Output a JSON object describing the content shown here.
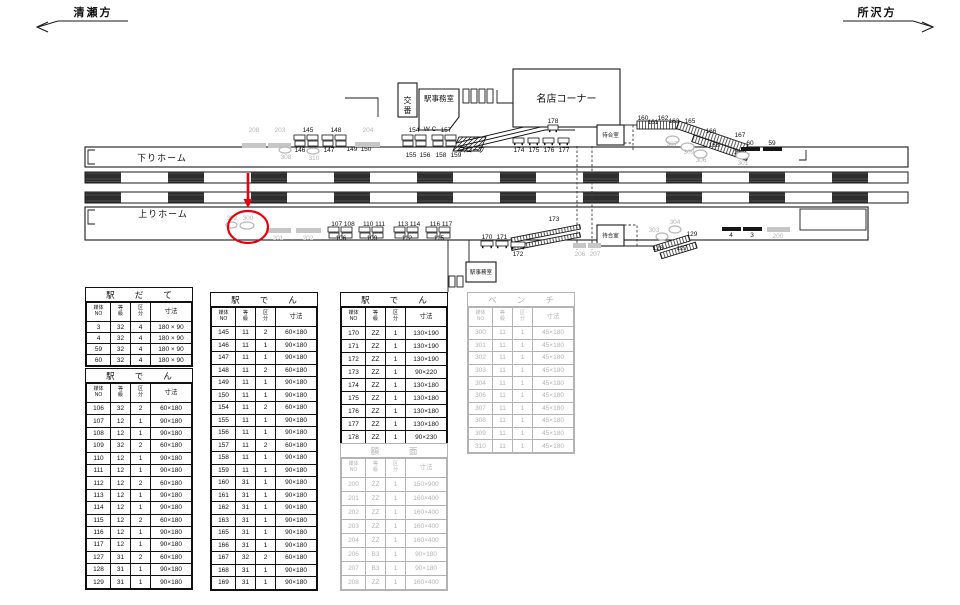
{
  "directions": {
    "left": "清瀬方",
    "right": "所沢方"
  },
  "diagram": {
    "down_platform": "下りホーム",
    "up_platform": "上りホーム",
    "buildings": [
      {
        "name": "koban",
        "label": "交番",
        "x": 398,
        "y": 83,
        "w": 19,
        "h": 34,
        "vertical": true,
        "fs": 8
      },
      {
        "name": "station-office-down",
        "label": "駅事務室",
        "x": 419,
        "y": 89,
        "w": 40,
        "h": 41,
        "fs": 7.5,
        "ty": 101,
        "pent": true
      },
      {
        "name": "meiten-corner",
        "label": "名店コーナー",
        "x": 513,
        "y": 69,
        "w": 107,
        "h": 58,
        "fs": 10
      },
      {
        "name": "waiting-room-down",
        "label": "待合室",
        "x": 597,
        "y": 125,
        "w": 27,
        "h": 20,
        "fs": 5.5
      },
      {
        "name": "waiting-room-up",
        "label": "待合室",
        "x": 597,
        "y": 225,
        "w": 27,
        "h": 21,
        "fs": 5.5
      },
      {
        "name": "station-office-up",
        "label": "駅事務室",
        "x": 466,
        "y": 262,
        "w": 30,
        "h": 20,
        "fs": 5.5
      }
    ],
    "markers": [
      {
        "t": "graybar",
        "x": 242,
        "y": 143,
        "w": 24,
        "label": "208",
        "lx": 254,
        "ly": 132,
        "gray": true
      },
      {
        "t": "graybar",
        "x": 268,
        "y": 143,
        "w": 23,
        "label": "203",
        "lx": 280,
        "ly": 132,
        "gray": true
      },
      {
        "t": "cluster",
        "x": 294,
        "y": 135,
        "label": "145",
        "lx": 308,
        "ly": 132
      },
      {
        "t": "oval",
        "x": 279,
        "y": 147,
        "w": 12,
        "h": 6,
        "label": "308",
        "lx": 286,
        "ly": 159,
        "gray": true
      },
      {
        "t": "label",
        "label": "146",
        "lx": 300,
        "ly": 152
      },
      {
        "t": "oval",
        "x": 307,
        "y": 148,
        "w": 12,
        "h": 6,
        "label": "310",
        "lx": 314,
        "ly": 160,
        "gray": true
      },
      {
        "t": "label",
        "label": "147",
        "lx": 329,
        "ly": 152
      },
      {
        "t": "cluster",
        "x": 322,
        "y": 135,
        "label": "148",
        "lx": 336,
        "ly": 132
      },
      {
        "t": "label",
        "label": "149",
        "lx": 352,
        "ly": 151
      },
      {
        "t": "label",
        "label": "150",
        "lx": 366,
        "ly": 151
      },
      {
        "t": "graybar",
        "x": 355,
        "y": 142,
        "w": 25,
        "label": "204",
        "lx": 368,
        "ly": 132,
        "gray": true
      },
      {
        "t": "cluster",
        "x": 402,
        "y": 135,
        "label": "154",
        "lx": 414,
        "ly": 132
      },
      {
        "t": "label",
        "label": "W C",
        "lx": 430,
        "ly": 131
      },
      {
        "t": "cluster",
        "x": 432,
        "y": 135,
        "label": "157",
        "lx": 446,
        "ly": 132
      },
      {
        "t": "label",
        "label": "155",
        "lx": 411,
        "ly": 157
      },
      {
        "t": "label",
        "label": "156",
        "lx": 425,
        "ly": 157
      },
      {
        "t": "label",
        "label": "158",
        "lx": 441,
        "ly": 157
      },
      {
        "t": "label",
        "label": "159",
        "lx": 456,
        "ly": 157
      },
      {
        "t": "label",
        "label": "スロープ",
        "lx": 472,
        "ly": 152,
        "fs": 5.5
      },
      {
        "t": "board",
        "x": 513,
        "y": 138,
        "w": 11,
        "label": "174",
        "lx": 519,
        "ly": 152
      },
      {
        "t": "board",
        "x": 528,
        "y": 138,
        "w": 11,
        "label": "175",
        "lx": 534,
        "ly": 152
      },
      {
        "t": "board",
        "x": 543,
        "y": 138,
        "w": 11,
        "label": "176",
        "lx": 549,
        "ly": 152
      },
      {
        "t": "board",
        "x": 558,
        "y": 138,
        "w": 11,
        "label": "177",
        "lx": 564,
        "ly": 152
      },
      {
        "t": "board",
        "x": 548,
        "y": 125,
        "w": 10,
        "label": "178",
        "lx": 553,
        "ly": 123
      },
      {
        "t": "label",
        "label": "160",
        "lx": 643,
        "ly": 120
      },
      {
        "t": "label",
        "label": "161",
        "lx": 653,
        "ly": 124
      },
      {
        "t": "label",
        "label": "162",
        "lx": 663,
        "ly": 120
      },
      {
        "t": "label",
        "label": "163",
        "lx": 674,
        "ly": 123
      },
      {
        "t": "label",
        "label": "165",
        "lx": 690,
        "ly": 123
      },
      {
        "t": "label",
        "label": "166",
        "lx": 711,
        "ly": 133
      },
      {
        "t": "label",
        "label": "167",
        "lx": 740,
        "ly": 137
      },
      {
        "t": "label",
        "label": "168",
        "lx": 714,
        "ly": 147
      },
      {
        "t": "label",
        "label": "169",
        "lx": 739,
        "ly": 154
      },
      {
        "t": "oval",
        "x": 666,
        "y": 136,
        "w": 13,
        "h": 8,
        "label": "307",
        "lx": 672,
        "ly": 146,
        "gray": true
      },
      {
        "t": "oval",
        "x": 681,
        "y": 143,
        "w": 13,
        "h": 8,
        "label": "309",
        "lx": 689,
        "ly": 154,
        "gray": true
      },
      {
        "t": "oval",
        "x": 694,
        "y": 150,
        "w": 13,
        "h": 8,
        "label": "306",
        "lx": 701,
        "ly": 162,
        "gray": true
      },
      {
        "t": "blackbar",
        "x": 741,
        "y": 147,
        "w": 19,
        "label": "60",
        "lx": 750,
        "ly": 145
      },
      {
        "t": "blackbar",
        "x": 763,
        "y": 147,
        "w": 19,
        "label": "59",
        "lx": 772,
        "ly": 145
      },
      {
        "t": "oval",
        "x": 736,
        "y": 152,
        "w": 13,
        "h": 7,
        "label": "301",
        "lx": 743,
        "ly": 165,
        "gray": true
      },
      {
        "t": "oval",
        "x": 226,
        "y": 222,
        "w": 11,
        "h": 6,
        "label": "302",
        "lx": 232,
        "ly": 220,
        "gray": true
      },
      {
        "t": "oval",
        "x": 240,
        "y": 222,
        "w": 14,
        "h": 7,
        "label": "300",
        "lx": 248,
        "ly": 220,
        "gray": true
      },
      {
        "t": "graybar",
        "x": 266,
        "y": 228,
        "w": 25,
        "label": "201",
        "lx": 278,
        "ly": 240,
        "gray": true
      },
      {
        "t": "graybar",
        "x": 296,
        "y": 228,
        "w": 25,
        "label": "202",
        "lx": 308,
        "ly": 240,
        "gray": true
      },
      {
        "t": "cluster",
        "x": 328,
        "y": 227
      },
      {
        "t": "label",
        "label": "107 108",
        "lx": 343,
        "ly": 226
      },
      {
        "t": "label",
        "label": "106",
        "lx": 341,
        "ly": 240
      },
      {
        "t": "cluster",
        "x": 359,
        "y": 227
      },
      {
        "t": "label",
        "label": "110 111",
        "lx": 374,
        "ly": 226
      },
      {
        "t": "label",
        "label": "109",
        "lx": 372,
        "ly": 240
      },
      {
        "t": "cluster",
        "x": 394,
        "y": 227
      },
      {
        "t": "label",
        "label": "113 114",
        "lx": 409,
        "ly": 226
      },
      {
        "t": "label",
        "label": "112",
        "lx": 407,
        "ly": 240
      },
      {
        "t": "cluster",
        "x": 426,
        "y": 227
      },
      {
        "t": "label",
        "label": "116 117",
        "lx": 441,
        "ly": 226
      },
      {
        "t": "label",
        "label": "115",
        "lx": 439,
        "ly": 240
      },
      {
        "t": "board",
        "x": 481,
        "y": 241,
        "w": 12,
        "label": "170",
        "lx": 487,
        "ly": 239
      },
      {
        "t": "board",
        "x": 496,
        "y": 241,
        "w": 12,
        "label": "171",
        "lx": 502,
        "ly": 239
      },
      {
        "t": "board",
        "x": 511,
        "y": 242,
        "w": 14,
        "label": "172",
        "lx": 518,
        "ly": 256
      },
      {
        "t": "label",
        "label": "173",
        "lx": 554,
        "ly": 221
      },
      {
        "t": "graybar",
        "x": 573,
        "y": 243,
        "w": 13,
        "label": "206",
        "lx": 580,
        "ly": 256,
        "gray": true
      },
      {
        "t": "graybar",
        "x": 588,
        "y": 243,
        "w": 13,
        "label": "207",
        "lx": 595,
        "ly": 256,
        "gray": true
      },
      {
        "t": "oval",
        "x": 656,
        "y": 233,
        "w": 12,
        "h": 7,
        "label": "303",
        "lx": 654,
        "ly": 232,
        "gray": true,
        "anchor": "end"
      },
      {
        "t": "oval",
        "x": 669,
        "y": 226,
        "w": 12,
        "h": 7,
        "label": "304",
        "lx": 675,
        "ly": 224,
        "gray": true
      },
      {
        "t": "label",
        "label": "128",
        "lx": 658,
        "ly": 250
      },
      {
        "t": "label",
        "label": "127",
        "lx": 682,
        "ly": 250
      },
      {
        "t": "label",
        "label": "129",
        "lx": 692,
        "ly": 236
      },
      {
        "t": "blackbar",
        "x": 722,
        "y": 227,
        "w": 19,
        "label": "4",
        "lx": 731,
        "ly": 237
      },
      {
        "t": "blackbar",
        "x": 743,
        "y": 227,
        "w": 19,
        "label": "3",
        "lx": 752,
        "ly": 237
      },
      {
        "t": "graybar",
        "x": 767,
        "y": 227,
        "w": 23,
        "label": "200",
        "lx": 778,
        "ly": 238,
        "gray": true
      }
    ]
  },
  "annotation_color": "#e8000d",
  "table_header": [
    [
      "媒体",
      "NO"
    ],
    [
      "等",
      "級"
    ],
    [
      "区",
      "分"
    ],
    [
      "寸法"
    ]
  ],
  "tables": [
    {
      "name": "eki-date",
      "title": "駅だて",
      "gray": false,
      "x": 85,
      "y": 287,
      "w": 108,
      "rowH": 11,
      "rows": [
        [
          "3",
          "32",
          "4",
          "180 × 90"
        ],
        [
          "4",
          "32",
          "4",
          "180 × 90"
        ],
        [
          "59",
          "32",
          "4",
          "180 × 90"
        ],
        [
          "60",
          "32",
          "4",
          "180 × 90"
        ]
      ]
    },
    {
      "name": "eki-den-1",
      "title": "駅でん",
      "gray": false,
      "x": 85,
      "y": 368,
      "w": 108,
      "rowH": 12.4,
      "rows": [
        [
          "106",
          "32",
          "2",
          "60×180"
        ],
        [
          "107",
          "12",
          "1",
          "90×180"
        ],
        [
          "108",
          "12",
          "1",
          "90×180"
        ],
        [
          "109",
          "32",
          "2",
          "60×180"
        ],
        [
          "110",
          "12",
          "1",
          "90×180"
        ],
        [
          "111",
          "12",
          "1",
          "90×180"
        ],
        [
          "112",
          "12",
          "2",
          "60×180"
        ],
        [
          "113",
          "12",
          "1",
          "90×180"
        ],
        [
          "114",
          "12",
          "1",
          "90×180"
        ],
        [
          "115",
          "12",
          "2",
          "60×180"
        ],
        [
          "116",
          "12",
          "1",
          "90×180"
        ],
        [
          "117",
          "12",
          "1",
          "90×180"
        ],
        [
          "127",
          "31",
          "2",
          "60×180"
        ],
        [
          "128",
          "31",
          "1",
          "90×180"
        ],
        [
          "129",
          "31",
          "1",
          "90×180"
        ]
      ]
    },
    {
      "name": "eki-den-2",
      "title": "駅でん",
      "gray": false,
      "x": 210,
      "y": 292,
      "w": 108,
      "rowH": 12.5,
      "rows": [
        [
          "145",
          "11",
          "2",
          "60×180"
        ],
        [
          "146",
          "11",
          "1",
          "90×180"
        ],
        [
          "147",
          "11",
          "1",
          "90×180"
        ],
        [
          "148",
          "11",
          "2",
          "60×180"
        ],
        [
          "149",
          "11",
          "1",
          "90×180"
        ],
        [
          "150",
          "11",
          "1",
          "90×180"
        ],
        [
          "154",
          "11",
          "2",
          "60×180"
        ],
        [
          "155",
          "11",
          "1",
          "90×180"
        ],
        [
          "156",
          "11",
          "1",
          "90×180"
        ],
        [
          "157",
          "11",
          "2",
          "60×180"
        ],
        [
          "158",
          "11",
          "1",
          "90×180"
        ],
        [
          "159",
          "11",
          "1",
          "90×180"
        ],
        [
          "160",
          "31",
          "1",
          "90×180"
        ],
        [
          "161",
          "31",
          "1",
          "90×180"
        ],
        [
          "162",
          "31",
          "1",
          "90×180"
        ],
        [
          "163",
          "31",
          "1",
          "90×180"
        ],
        [
          "165",
          "31",
          "1",
          "90×180"
        ],
        [
          "166",
          "31",
          "1",
          "90×180"
        ],
        [
          "167",
          "32",
          "2",
          "60×180"
        ],
        [
          "168",
          "31",
          "1",
          "90×180"
        ],
        [
          "169",
          "31",
          "1",
          "90×180"
        ]
      ]
    },
    {
      "name": "eki-den-3",
      "title": "駅でん",
      "gray": false,
      "x": 340,
      "y": 292,
      "w": 108,
      "rowH": 13,
      "rows": [
        [
          "170",
          "ZZ",
          "1",
          "130×190"
        ],
        [
          "171",
          "ZZ",
          "1",
          "130×190"
        ],
        [
          "172",
          "ZZ",
          "1",
          "130×190"
        ],
        [
          "173",
          "ZZ",
          "1",
          "90×220"
        ],
        [
          "174",
          "ZZ",
          "1",
          "130×180"
        ],
        [
          "175",
          "ZZ",
          "1",
          "130×180"
        ],
        [
          "176",
          "ZZ",
          "1",
          "130×180"
        ],
        [
          "177",
          "ZZ",
          "1",
          "130×180"
        ],
        [
          "178",
          "ZZ",
          "1",
          "90×230"
        ]
      ]
    },
    {
      "name": "gakumen",
      "title": "額面",
      "gray": true,
      "x": 340,
      "y": 443,
      "w": 108,
      "rowH": 14,
      "rows": [
        [
          "200",
          "ZZ",
          "1",
          "150×900"
        ],
        [
          "201",
          "ZZ",
          "1",
          "160×400"
        ],
        [
          "202",
          "ZZ",
          "1",
          "160×400"
        ],
        [
          "203",
          "ZZ",
          "1",
          "160×400"
        ],
        [
          "204",
          "ZZ",
          "1",
          "160×400"
        ],
        [
          "206",
          "B3",
          "1",
          "90×180"
        ],
        [
          "207",
          "B3",
          "1",
          "90×180"
        ],
        [
          "208",
          "ZZ",
          "1",
          "160×400"
        ]
      ]
    },
    {
      "name": "bench",
      "title": "ベンチ",
      "gray": true,
      "x": 467,
      "y": 292,
      "w": 108,
      "rowH": 12.6,
      "rows": [
        [
          "300",
          "11",
          "1",
          "45×180"
        ],
        [
          "301",
          "11",
          "1",
          "45×180"
        ],
        [
          "302",
          "11",
          "1",
          "45×180"
        ],
        [
          "303",
          "11",
          "1",
          "45×180"
        ],
        [
          "304",
          "11",
          "1",
          "45×180"
        ],
        [
          "306",
          "11",
          "1",
          "45×180"
        ],
        [
          "307",
          "11",
          "1",
          "45×180"
        ],
        [
          "308",
          "11",
          "1",
          "45×180"
        ],
        [
          "309",
          "11",
          "1",
          "45×180"
        ],
        [
          "310",
          "11",
          "1",
          "45×180"
        ]
      ]
    }
  ]
}
